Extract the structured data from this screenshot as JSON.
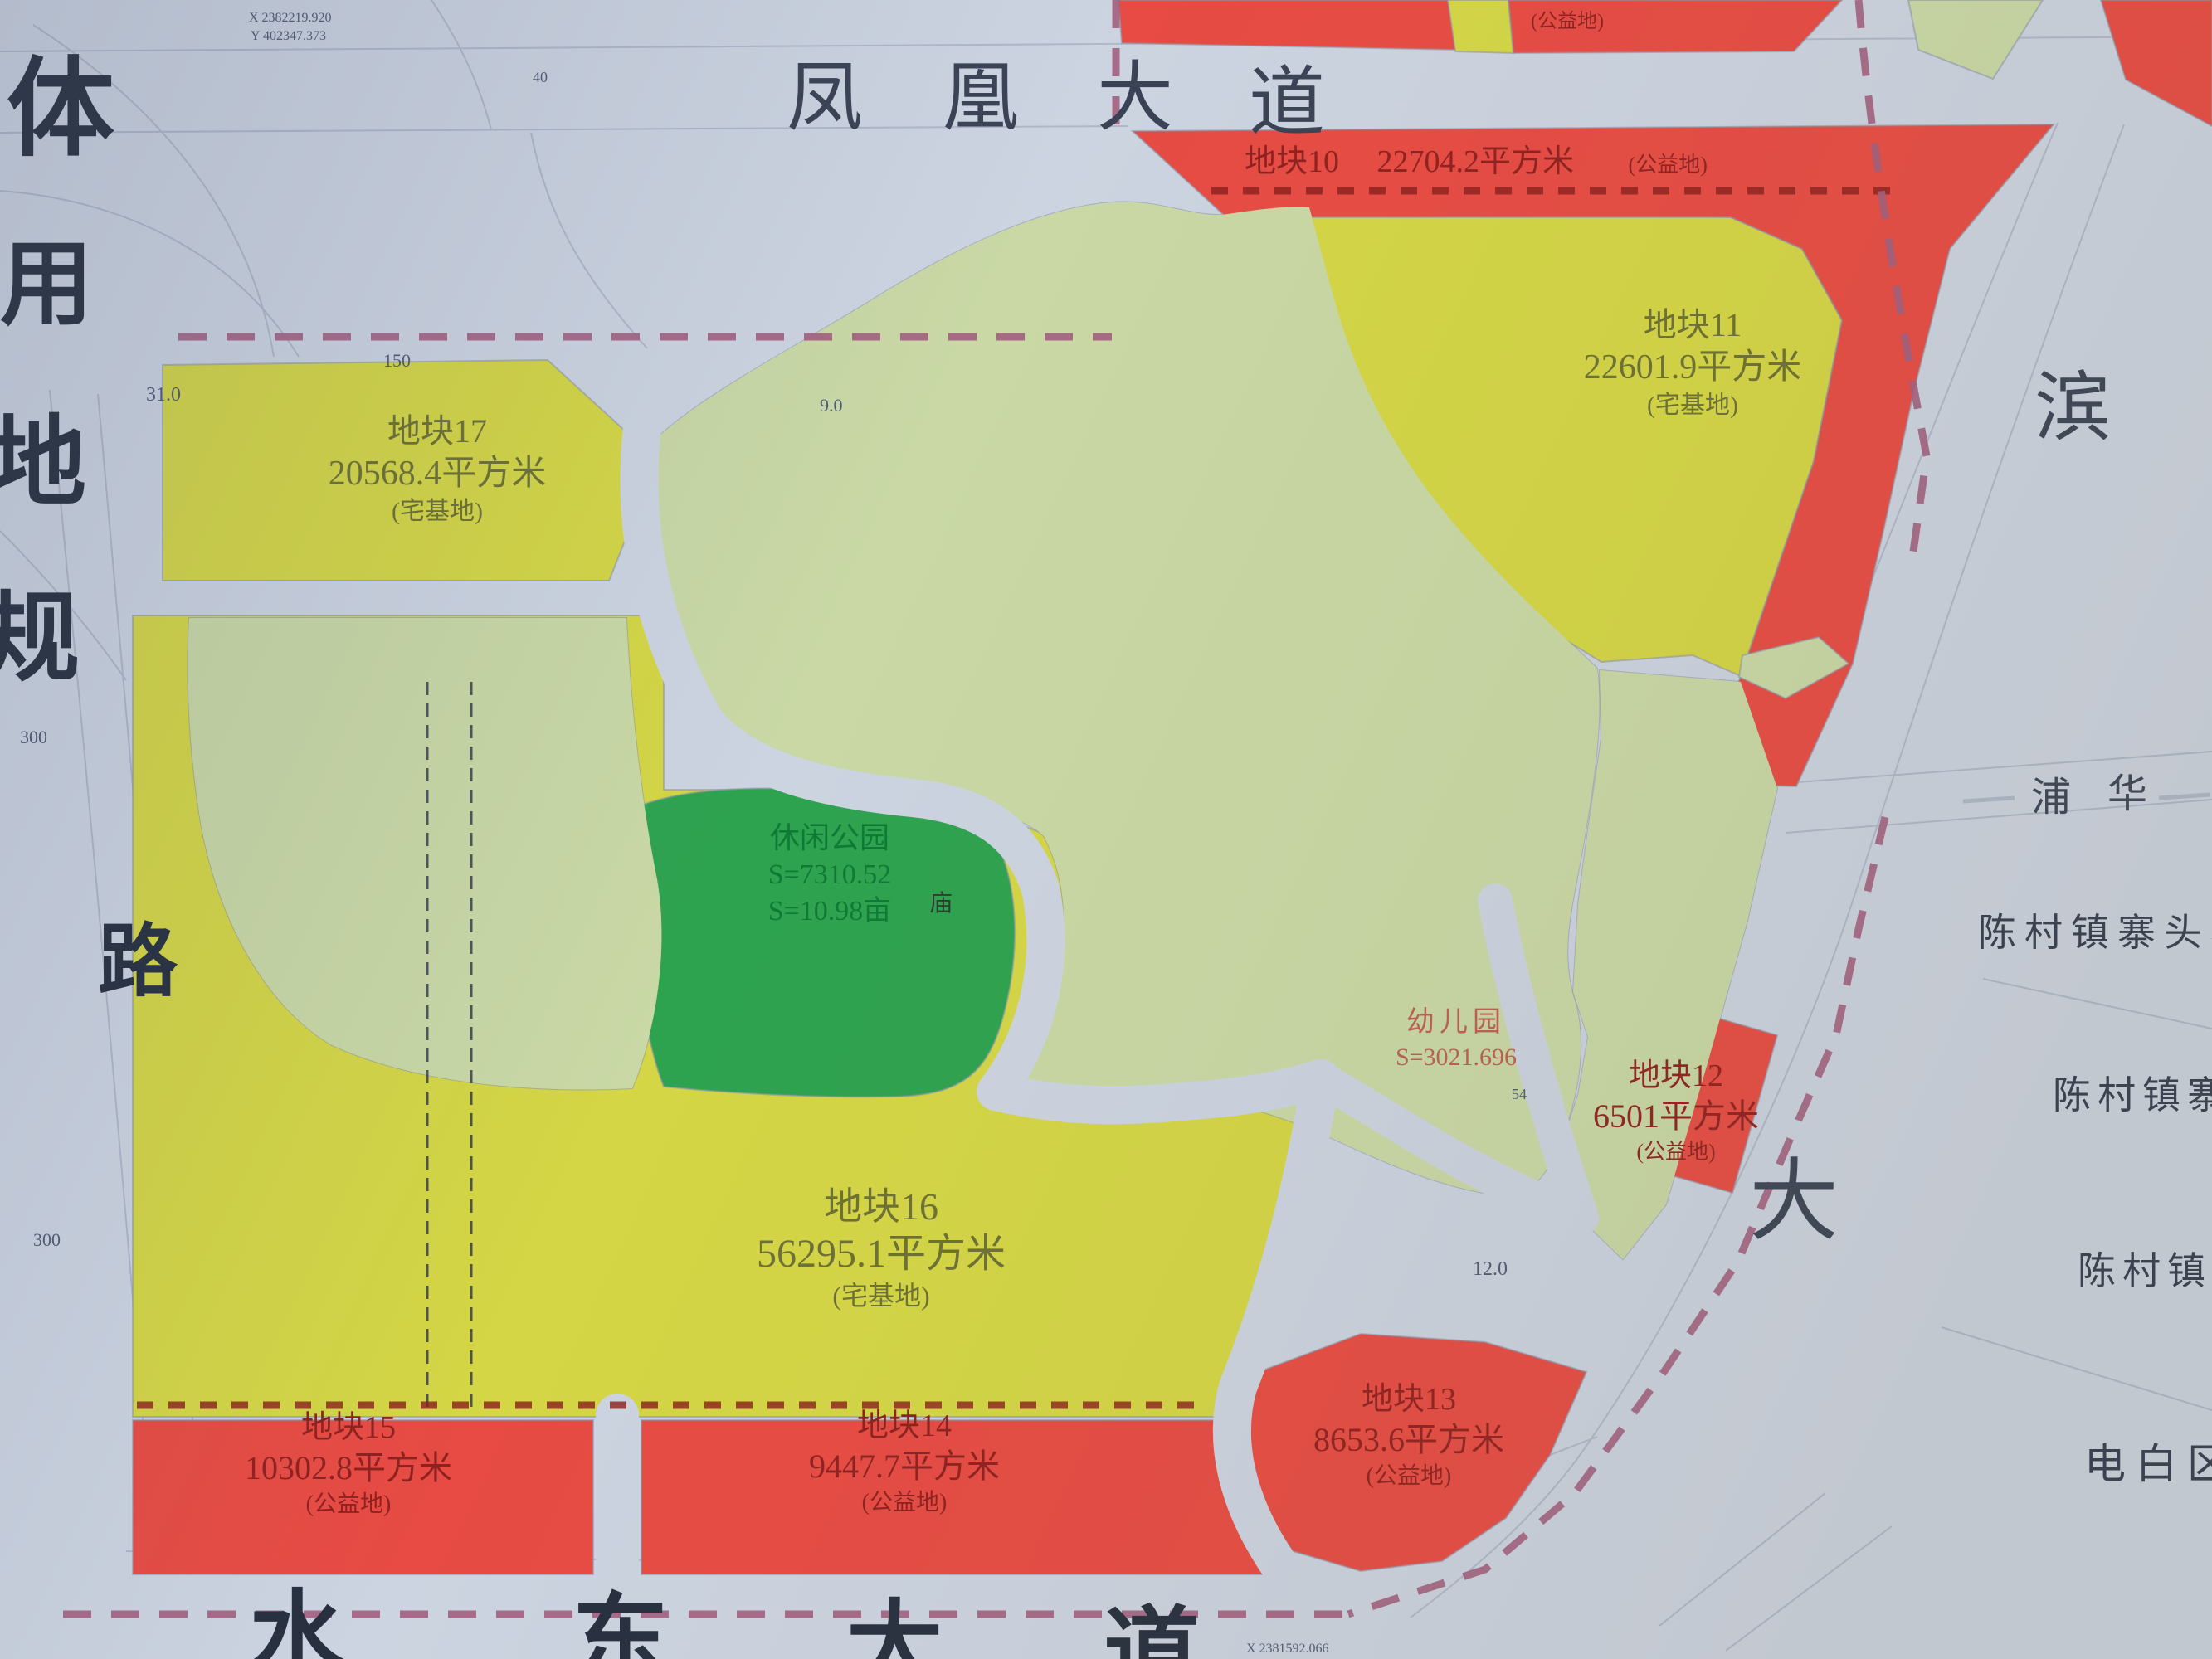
{
  "colors": {
    "paper": "#ccd4e1",
    "parcel_yellow": "#d4d645",
    "parcel_red": "#e74b43",
    "village_green": "#c9d8a5",
    "park_green": "#2ea34f",
    "kindergarten_orange": "#e2a43c",
    "boundary_pink": "#a25f80",
    "hatch_red": "#8c1f1e",
    "ink_dark": "#27303f"
  },
  "coords": {
    "top_x": "X 2382219.920",
    "top_y": "Y 402347.373",
    "bottom_x": "X 2381592.066"
  },
  "side_title": {
    "chars": [
      "体",
      "用",
      "地",
      "规"
    ],
    "road_char": "路"
  },
  "roads": {
    "phoenix": [
      "凤",
      "凰",
      "大",
      "道"
    ],
    "shuidong": [
      "水",
      "东",
      "大",
      "道"
    ],
    "binhai": [
      "滨",
      "大"
    ],
    "puhua": [
      "浦",
      "华"
    ]
  },
  "parcels": {
    "p10": {
      "name": "地块10",
      "area": "22704.2平方米",
      "tag": "(公益地)"
    },
    "p11": {
      "name": "地块11",
      "area": "22601.9平方米",
      "tag": "(宅基地)"
    },
    "p12": {
      "name": "地块12",
      "area": "6501平方米",
      "tag": "(公益地)"
    },
    "p13": {
      "name": "地块13",
      "area": "8653.6平方米",
      "tag": "(公益地)"
    },
    "p14": {
      "name": "地块14",
      "area": "9447.7平方米",
      "tag": "(公益地)"
    },
    "p15": {
      "name": "地块15",
      "area": "10302.8平方米",
      "tag": "(公益地)"
    },
    "p16": {
      "name": "地块16",
      "area": "56295.1平方米",
      "tag": "(宅基地)"
    },
    "p17": {
      "name": "地块17",
      "area": "20568.4平方米",
      "tag": "(宅基地)"
    }
  },
  "features": {
    "park": {
      "name": "休闲公园",
      "area1": "S=7310.52",
      "area2": "S=10.98亩"
    },
    "kindergarten": {
      "name": "幼儿园",
      "area": "S=3021.696"
    },
    "temple": "庙",
    "top_right_tag": "(公益地)"
  },
  "east_labels": [
    "陈村镇寨头小",
    "陈村镇寨",
    "陈村镇",
    "电白区"
  ],
  "dims": {
    "d31": "31.0",
    "d150": "150",
    "d9": "9.0",
    "d12": "12.0",
    "d300a": "300",
    "d300b": "300",
    "d54": "54",
    "d40": "40"
  }
}
